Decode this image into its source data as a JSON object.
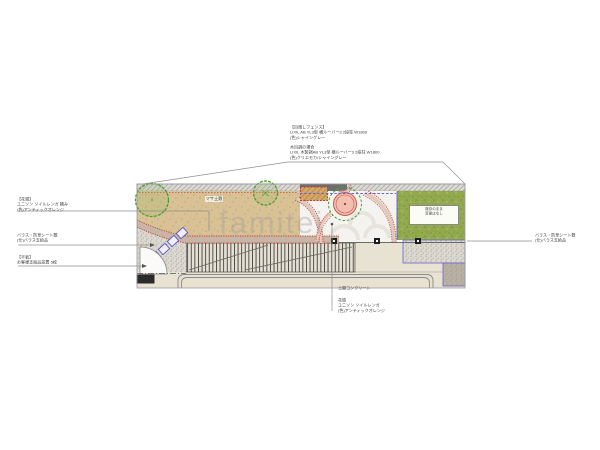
{
  "drawing": {
    "watermark": "famitei",
    "plan_labels": {
      "masa_soil": "マサ土敷",
      "lawn_note_line1": "既存のまま",
      "lawn_note_line2": "変更はなし"
    },
    "annotations": {
      "fence": {
        "title": "【目隠しフェンス】",
        "spec": "LIXIL AB YL3型 横ルーバー3 2段柱 W1800",
        "color": "(色)シャイングレー",
        "alt_title": "木目調の場合",
        "alt_spec": "LIXIL 木製調AB YL3型 横ルーバー3 2段柱 W1800",
        "alt_color": "(色)クリエモカ/シャイングレー"
      },
      "flowerbed_left": {
        "title": "【花壇】",
        "spec": "ユニソン ソイルレンガ 積み",
        "color": "(色)アンティックオレンジ"
      },
      "gravel_left": {
        "spec": "バラス・防草シート敷",
        "note": "(仕)バラス支給品"
      },
      "slabs": {
        "title": "【平板】",
        "spec": "お客様支給品設置 5枚"
      },
      "gravel_right": {
        "spec": "バラス・防草シート敷",
        "note": "(仕)バラス支給品"
      },
      "concrete": {
        "label": "土間コンクリート"
      },
      "flowerbed_center": {
        "title": "花壇",
        "spec": "ユニソン ソイルレンガ",
        "color": "(色)アンティックオレンジ"
      }
    },
    "colors": {
      "tan": "#d8c194",
      "lawn": "#92a94d",
      "brick_red": "#b8463c",
      "brick_fill": "#c9b5a5",
      "concrete": "#f4f3ef",
      "beige": "#e8e2d3",
      "gravel": "#dcd9d1",
      "taupe": "#b8b1a4",
      "blue_line": "#6464cf",
      "tree_green": "#4f9a37",
      "planter_pink": "#f3bfb2"
    }
  }
}
